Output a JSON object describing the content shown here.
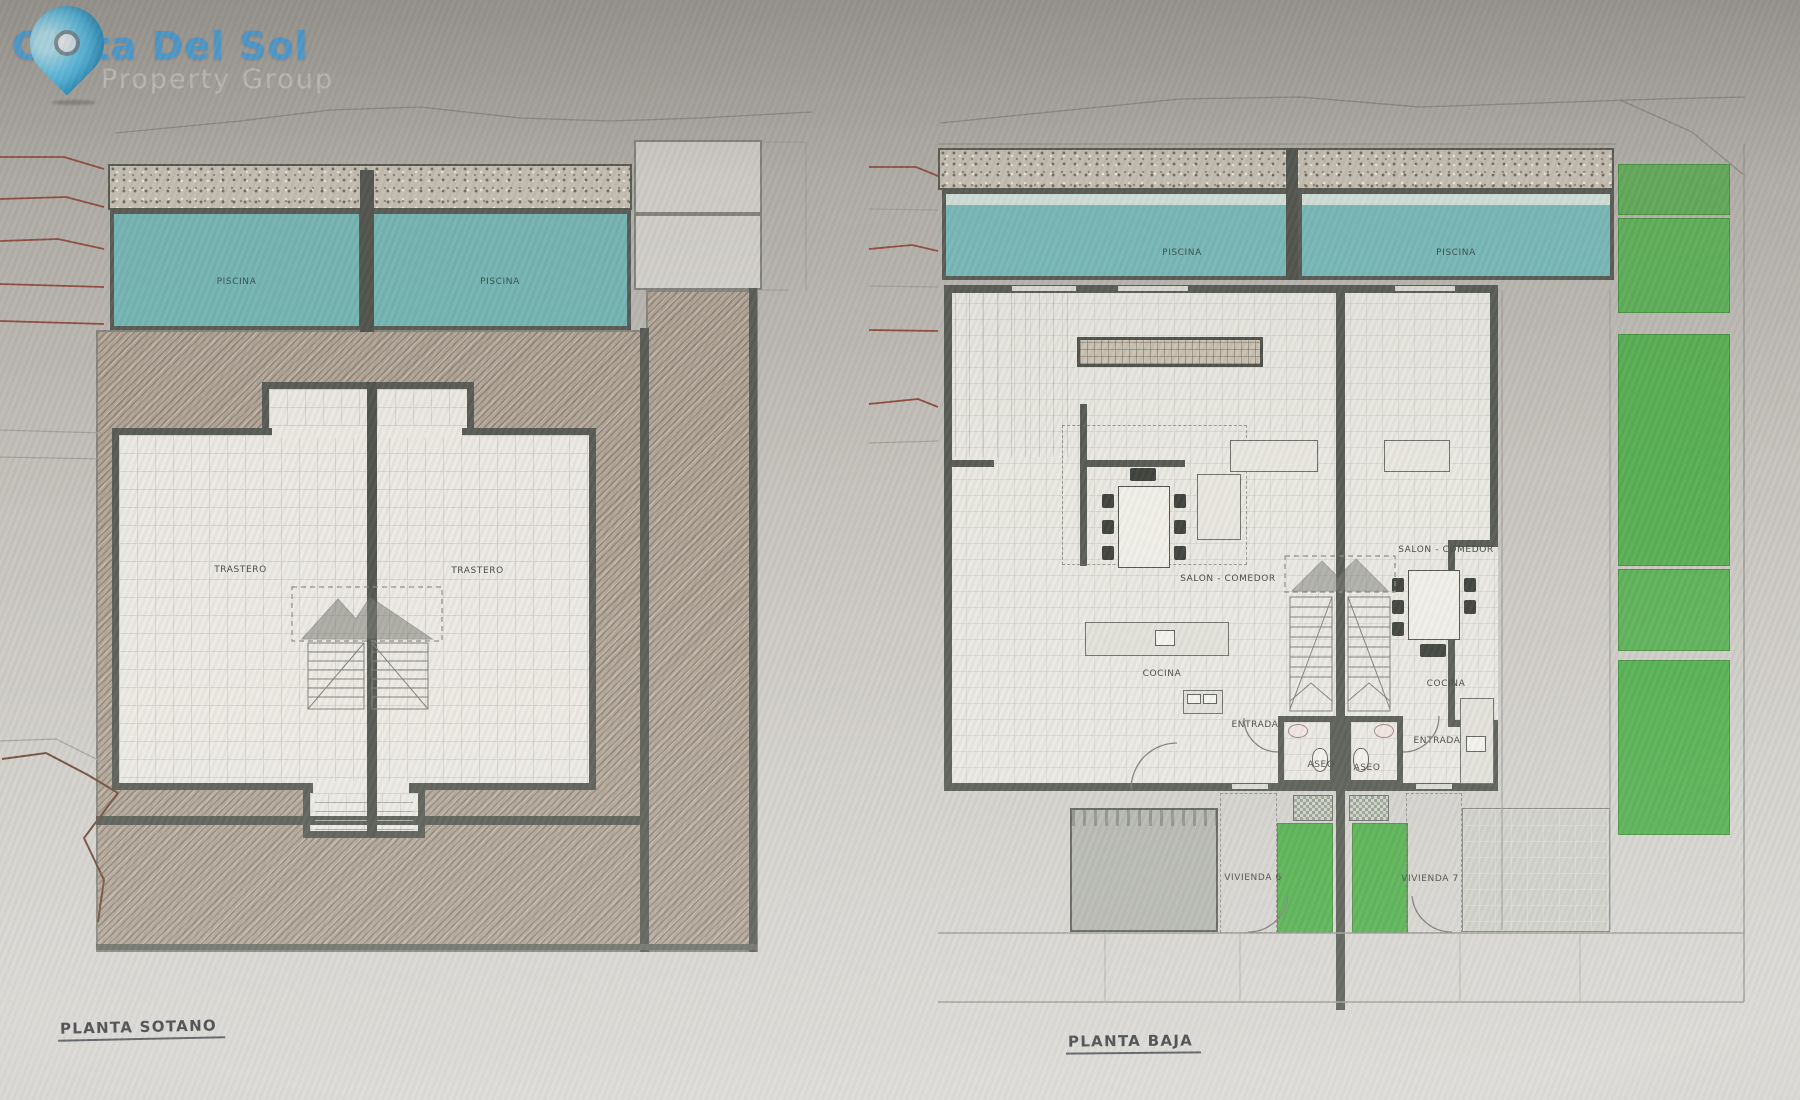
{
  "logo": {
    "brand": "Costa Del Sol",
    "tagline": "Property Group",
    "pin_icon": "map-pin",
    "brand_color": "#4ba6e2",
    "tagline_color": "#c9c7c3"
  },
  "plan_sotano": {
    "title": "PLANTA SOTANO",
    "piscina_left": "PISCINA",
    "piscina_right": "PISCINA",
    "trastero_left": "TRASTERO",
    "trastero_right": "TRASTERO"
  },
  "plan_baja": {
    "title": "PLANTA BAJA",
    "piscina_left": "PISCINA",
    "piscina_right": "PISCINA",
    "salon_left": "SALON - COMEDOR",
    "salon_right": "SALON - COMEDOR",
    "cocina_left": "COCINA",
    "cocina_right": "COCINA",
    "entrada_left": "ENTRADA",
    "entrada_right": "ENTRADA",
    "aseo_left": "ASEO",
    "aseo_right": "ASEO",
    "vivienda_left": "VIVIENDA 6",
    "vivienda_right": "VIVIENDA 7"
  },
  "colors": {
    "pool": "#74b7b5",
    "lawn": "#58ac52",
    "wall": "#575b53",
    "ground_hatch": "#b2a698",
    "paper": "#cfccc7",
    "contour_red": "#8f4a3c"
  }
}
